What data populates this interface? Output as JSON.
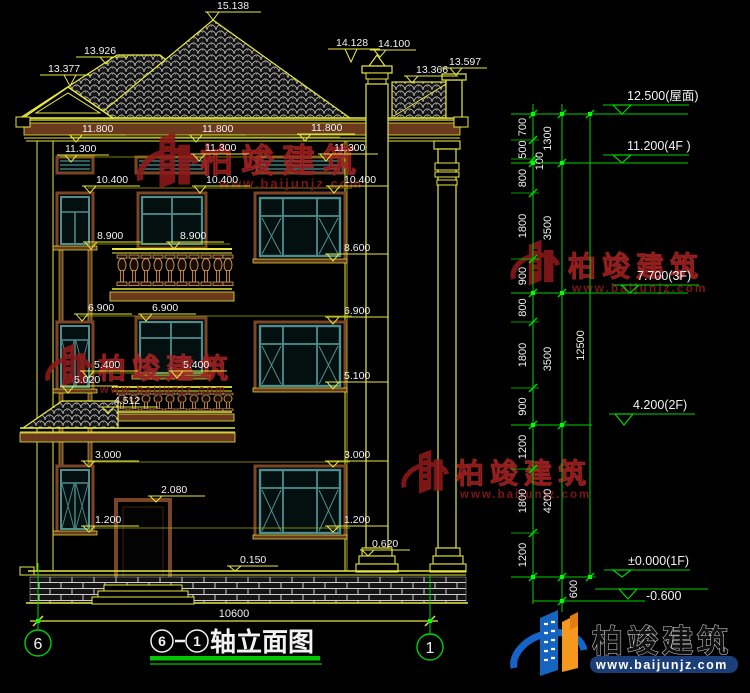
{
  "colors": {
    "line_yellow": "#e8e840",
    "leader_yellow": "#a8a800",
    "dim_green": "#00d400",
    "text_white": "#f2f2f2",
    "trim_brown": "#6b3a1d",
    "window_teal": "#4E8E8E",
    "watermark_red": "#8e1a1a",
    "logo_blue": "#1664c8",
    "logo_orange": "#f5991e"
  },
  "annotations": [
    {
      "t": "15.138",
      "x": 217,
      "y": 9,
      "tip": [
        213,
        20
      ]
    },
    {
      "t": "13.926",
      "x": 84,
      "y": 54,
      "tip": [
        106,
        64
      ]
    },
    {
      "t": "13.377",
      "x": 48,
      "y": 72,
      "tip": [
        70,
        86
      ]
    },
    {
      "t": "14.128",
      "x": 336,
      "y": 46,
      "tip": [
        351,
        62
      ]
    },
    {
      "t": "14.100",
      "x": 378,
      "y": 47,
      "tip": [
        380,
        57
      ],
      "lw": 38
    },
    {
      "t": "13.366",
      "x": 416,
      "y": 73,
      "tip": [
        412,
        83
      ],
      "lw": 42
    },
    {
      "t": "13.597",
      "x": 449,
      "y": 65,
      "tip": [
        456,
        75
      ],
      "lw": 38
    },
    {
      "t": "11.800",
      "x": 82,
      "y": 132,
      "tip": [
        76,
        142
      ]
    },
    {
      "t": "11.800",
      "x": 202,
      "y": 132,
      "tip": [
        196,
        142
      ]
    },
    {
      "t": "11.800",
      "x": 311,
      "y": 131,
      "tip": [
        305,
        141
      ]
    },
    {
      "t": "11.300",
      "x": 65,
      "y": 152,
      "tip": [
        71,
        162
      ]
    },
    {
      "t": "11.300",
      "x": 205,
      "y": 151,
      "tip": [
        199,
        161
      ]
    },
    {
      "t": "11.300",
      "x": 334,
      "y": 151,
      "tip": [
        326,
        161
      ]
    },
    {
      "t": "10.400",
      "x": 96,
      "y": 183,
      "tip": [
        90,
        193
      ]
    },
    {
      "t": "10.400",
      "x": 206,
      "y": 183,
      "tip": [
        200,
        193
      ]
    },
    {
      "t": "10.400",
      "x": 344,
      "y": 183,
      "tip": [
        334,
        193
      ]
    },
    {
      "t": "8.900",
      "x": 97,
      "y": 239,
      "tip": [
        91,
        249
      ]
    },
    {
      "t": "8.900",
      "x": 180,
      "y": 239,
      "tip": [
        174,
        249
      ]
    },
    {
      "t": "8.600",
      "x": 344,
      "y": 251,
      "tip": [
        333,
        261
      ]
    },
    {
      "t": "6.900",
      "x": 88,
      "y": 311,
      "tip": [
        82,
        321
      ]
    },
    {
      "t": "6.900",
      "x": 152,
      "y": 311,
      "tip": [
        146,
        321
      ]
    },
    {
      "t": "6.900",
      "x": 344,
      "y": 314,
      "tip": [
        333,
        324
      ]
    },
    {
      "t": "5.400",
      "x": 94,
      "y": 368,
      "tip": [
        88,
        378
      ]
    },
    {
      "t": "5.400",
      "x": 183,
      "y": 368,
      "tip": [
        177,
        378
      ]
    },
    {
      "t": "5.100",
      "x": 344,
      "y": 379,
      "tip": [
        333,
        389
      ]
    },
    {
      "t": "5.020",
      "x": 74,
      "y": 383,
      "tip": [
        68,
        393
      ]
    },
    {
      "t": "4.512",
      "x": 114,
      "y": 404,
      "tip": [
        108,
        414
      ]
    },
    {
      "t": "3.000",
      "x": 95,
      "y": 458,
      "tip": [
        89,
        467
      ]
    },
    {
      "t": "3.000",
      "x": 344,
      "y": 458,
      "tip": [
        333,
        467
      ]
    },
    {
      "t": "2.080",
      "x": 161,
      "y": 493,
      "tip": [
        156,
        502
      ]
    },
    {
      "t": "1.200",
      "x": 95,
      "y": 523,
      "tip": [
        89,
        532
      ]
    },
    {
      "t": "1.200",
      "x": 344,
      "y": 523,
      "tip": [
        333,
        532
      ]
    },
    {
      "t": "0.620",
      "x": 372,
      "y": 547,
      "tip": [
        368,
        556
      ],
      "lw": 38
    },
    {
      "t": "0.150",
      "x": 240,
      "y": 563,
      "tip": [
        235,
        571
      ],
      "lw": 38
    }
  ],
  "right_dims": {
    "verticals": [
      {
        "x": 533,
        "y1": 104,
        "y2": 604
      },
      {
        "x": 562,
        "y1": 104,
        "y2": 612
      },
      {
        "x": 590,
        "y1": 114,
        "y2": 578
      }
    ],
    "level_lines": [
      {
        "y": 114,
        "x1": 511,
        "x2": 688
      },
      {
        "y": 163,
        "x1": 511,
        "x2": 688
      },
      {
        "y": 293,
        "x1": 511,
        "x2": 688
      },
      {
        "y": 425,
        "x1": 511,
        "x2": 592
      },
      {
        "y": 577,
        "x1": 511,
        "x2": 592
      },
      {
        "y": 589,
        "x1": 595,
        "x2": 683
      },
      {
        "y": 601,
        "x1": 533,
        "x2": 645
      }
    ],
    "cols": [
      {
        "x": 533,
        "lx": 526,
        "b": [
          114,
          140,
          159,
          163,
          193,
          259,
          293,
          322,
          388,
          425,
          469,
          533,
          577
        ],
        "labels": [
          {
            "v": "700"
          },
          {
            "v": "500"
          },
          {
            "v": "100",
            "ox": 17
          },
          {
            "v": "800"
          },
          {
            "v": "1800"
          },
          {
            "v": "900"
          },
          {
            "v": "800"
          },
          {
            "v": "1800"
          },
          {
            "v": "900"
          },
          {
            "v": "1200"
          },
          {
            "v": "1800"
          },
          {
            "v": "1200"
          }
        ]
      },
      {
        "x": 562,
        "lx": 551,
        "b": [
          114,
          163,
          293,
          425,
          577,
          601
        ],
        "labels": [
          {
            "v": "1300"
          },
          {
            "v": "3500"
          },
          {
            "v": "3500"
          },
          {
            "v": "4200"
          },
          {
            "v": "600",
            "ox": 26
          }
        ]
      },
      {
        "x": 590,
        "lx": 584,
        "b": [
          114,
          577
        ],
        "labels": [
          {
            "v": "12500"
          }
        ]
      }
    ],
    "levels": [
      {
        "t": "12.500(屋面)",
        "tx": 627,
        "ty": 100,
        "lineY": 105,
        "ax": 622,
        "levelY": 114
      },
      {
        "t": "11.200(4F )",
        "tx": 627,
        "ty": 150,
        "lineY": 155,
        "ax": 622,
        "levelY": 163
      },
      {
        "t": "7.700(3F)",
        "tx": 637,
        "ty": 280,
        "lineY": 285,
        "ax": 630,
        "levelY": 293
      },
      {
        "t": "4.200(2F)",
        "tx": 633,
        "ty": 409,
        "lineY": 414,
        "ax": 624,
        "levelY": 425
      },
      {
        "t": "±0.000(1F)",
        "tx": 628,
        "ty": 565,
        "lineY": 570,
        "ax": 622,
        "levelY": 577
      },
      {
        "t": "-0.600",
        "tx": 646,
        "ty": 600,
        "lineY": 589,
        "ax": 628,
        "levelY": 599
      }
    ],
    "grips": [
      [
        533,
        114
      ],
      [
        533,
        163
      ],
      [
        533,
        293
      ],
      [
        533,
        425
      ],
      [
        533,
        577
      ],
      [
        562,
        114
      ],
      [
        562,
        163
      ],
      [
        562,
        293
      ],
      [
        562,
        425
      ],
      [
        562,
        577
      ],
      [
        562,
        601
      ],
      [
        590,
        114
      ],
      [
        590,
        577
      ],
      [
        38,
        621
      ],
      [
        430,
        621
      ]
    ]
  },
  "watermark": {
    "brand": "柏竣建筑",
    "url": "www.baijunjz.com",
    "instances": [
      {
        "bx": 200,
        "by": 172,
        "bfs": 33,
        "bls": 8,
        "ux": 219,
        "uy": 188,
        "ufs": 13,
        "lx": 130,
        "ly": 130,
        "ls": 1.05
      },
      {
        "bx": 568,
        "by": 276,
        "bfs": 28,
        "bls": 6,
        "ux": 572,
        "uy": 292,
        "ufs": 12,
        "lx": 505,
        "ly": 238,
        "ls": 0.85
      },
      {
        "bx": 98,
        "by": 378,
        "bfs": 28,
        "bls": 6,
        "ux": 100,
        "uy": 393,
        "ufs": 11,
        "lx": 40,
        "ly": 342,
        "ls": 0.8
      },
      {
        "bx": 456,
        "by": 483,
        "bfs": 28,
        "bls": 6,
        "ux": 460,
        "uy": 498,
        "ufs": 11.5,
        "lx": 396,
        "ly": 448,
        "ls": 0.82
      }
    ]
  },
  "footer": {
    "axis_dim": "10600",
    "bubble_left": "6",
    "bubble_right": "1",
    "title_axis_start": "6",
    "title_axis_end": "1",
    "title_label": "轴立面图"
  },
  "logo": {
    "brand": "柏竣建筑",
    "url": "www.baijunjz.com"
  }
}
